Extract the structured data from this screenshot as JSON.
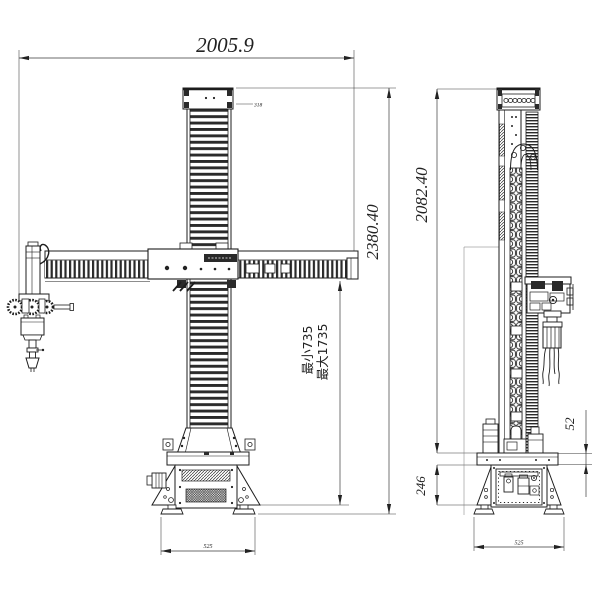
{
  "colors": {
    "background": "#ffffff",
    "line": "#1d1d1d",
    "dim_line": "#3a3a3a"
  },
  "front_view": {
    "dim_overall_width": "2005.9",
    "dim_overall_height": "2380.40",
    "dim_stroke_min": "最小735",
    "dim_stroke_max": "最大1735",
    "dim_cap_note": "318",
    "dim_base_width": "525"
  },
  "side_view": {
    "dim_column_height": "2082.40",
    "dim_plate_thickness": "52",
    "dim_base_height": "246",
    "dim_base_width": "525"
  }
}
